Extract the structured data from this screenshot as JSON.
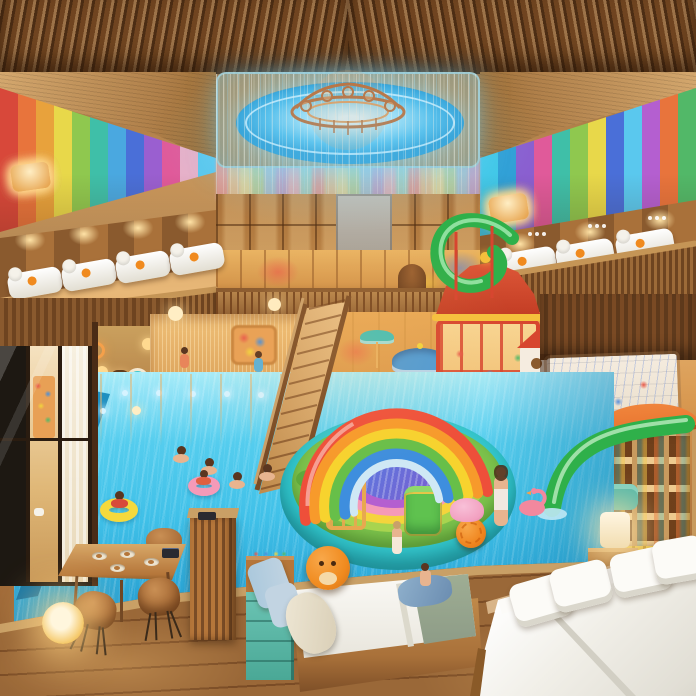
{
  "scene": {
    "title": "Colorful indoor family resort atrium with kids waterpark: wood-slat ceiling with blue LED dome and copper chandelier, rainbow striped walls, balconies with white lounge beds, grand wooden staircase, inflatable rainbow arch over a ring-colored splash island, turquoise pool with children on swim rings, red play tower with green spiral slide, kids corner with drawing wall and green slide, and in the foreground wooden deck with dining table, glowing orb lamp, a child's bed with orange plush and a large white double bed"
  },
  "palette": {
    "wood-slat": "#6e4420",
    "wood-soffit": "#c99a62",
    "wood-wall": "#a9713a",
    "deck-plank": "#9a6838",
    "dome-blue": "#52bdea",
    "copper": "#c06a30",
    "copper-light": "#e89a55",
    "glow-warm": "#ffd98f",
    "pool-light": "#8fe2f6",
    "pool-mid": "#3fc0e8",
    "pool-deep": "#1e93c8",
    "pool-edge-dark": "#136f9e",
    "pool-dot": "#d6f3ff",
    "island-teal": "#2fc3c9",
    "island-teal-dark": "#1f9aa8",
    "grass": "#7cc24c",
    "ring-yellow": "#f5d43c",
    "ring-pink": "#f59ab8",
    "rb-red": "#ee4f3a",
    "rb-orange": "#f79a2b",
    "rb-yellow": "#f7d32e",
    "rb-green": "#67bf49",
    "rb-blue": "#3e8ede",
    "rb-inner": "#cfe8f5",
    "slide-green": "#2fb04a",
    "slide-green-light": "#9fe0a8",
    "tower-red": "#d7452f",
    "hut-orange": "#e8742f",
    "carousel-blue": "#4a9ad8",
    "bed-white": "#f8f7f2",
    "pillow-blue": "#aac8dc",
    "blanket-sage": "#9fae94",
    "plush-orange": "#f08a1e",
    "dresser-teal": "#57b8a8",
    "chair": "#b5763a",
    "float-yellow": "#f5d93c",
    "float-pink": "#f59ab8",
    "skin": "#e8b48f",
    "hair": "#5a3620"
  },
  "stripes_left": [
    "#d8483a",
    "#e8743c",
    "#e8a23c",
    "#e8d84a",
    "#8fc84f",
    "#3fbfa8",
    "#4aa8e0",
    "#4a6fd8",
    "#9a5fd0",
    "#e05a9a",
    "#e8b0c8",
    "#5ac8ee"
  ],
  "stripes_right": [
    "#3fc8e8",
    "#2f9fd6",
    "#8a5fd0",
    "#e05a9a",
    "#3fbfa8",
    "#8fc84f",
    "#e8d84a",
    "#4a6fd8",
    "#5ac8ee",
    "#b45fd0",
    "#e8743c",
    "#52b868"
  ],
  "stripes_back": [
    "#e8a0a0",
    "#e8c8a0",
    "#e8e0a8",
    "#b8d8a8",
    "#a8c8e0",
    "#c0a8d8",
    "#e8b8c8",
    "#a8d8d0"
  ]
}
